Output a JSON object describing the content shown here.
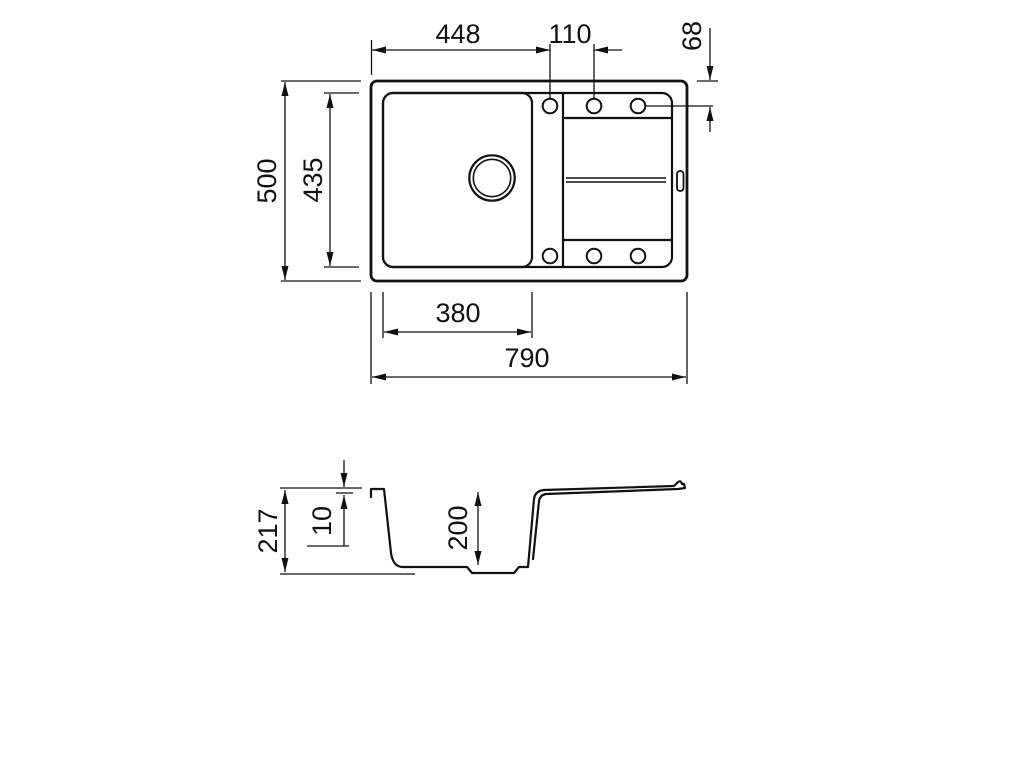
{
  "drawing": {
    "type": "technical-drawing",
    "subject": "Inset kitchen sink with single bowl and drainboard, dimensioned plan and section views",
    "units": "mm",
    "line_color": "#111111",
    "background_color": "#ffffff",
    "top_view": {
      "name": "plan-view",
      "overall_width": "790",
      "overall_depth": "500",
      "inner_depth": "435",
      "bowl_width": "380",
      "left_edge_to_first_hole": "448",
      "hole_spacing": "110",
      "edge_to_hole_axis": "68",
      "tap_hole_count": 6
    },
    "side_view": {
      "name": "section-view",
      "overall_height": "217",
      "rim_thickness": "10",
      "bowl_depth": "200"
    }
  }
}
